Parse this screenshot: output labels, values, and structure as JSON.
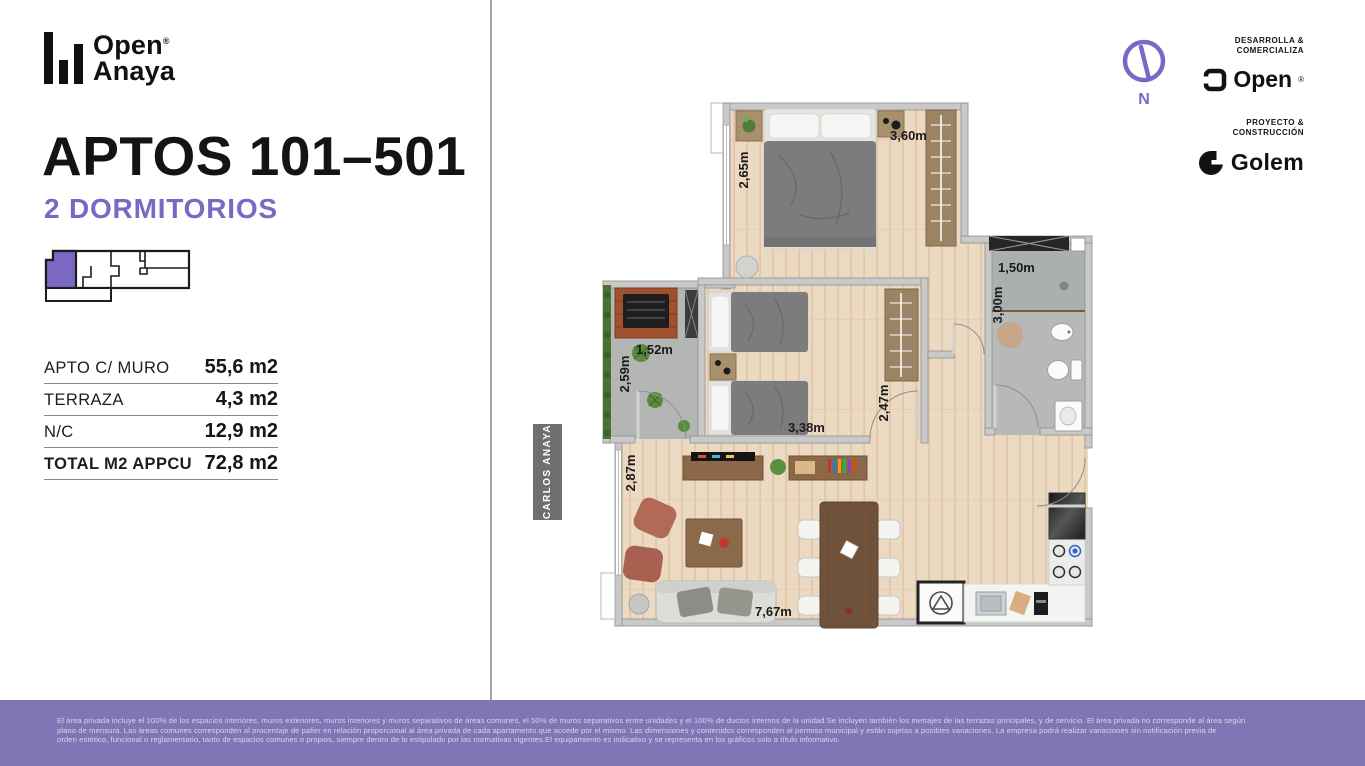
{
  "brand": {
    "name_line1": "Open",
    "name_line2": "Anaya",
    "registered": "®"
  },
  "left_panel": {
    "title": "APTOS 101–501",
    "subtitle": "2 DORMITORIOS",
    "area_table": {
      "rows": [
        {
          "label": "APTO C/ MURO",
          "value": "55,6 m2"
        },
        {
          "label": "TERRAZA",
          "value": "4,3 m2"
        },
        {
          "label": "N/C",
          "value": "12,9 m2"
        },
        {
          "label": "TOTAL M2 APPCU",
          "value": "72,8 m2"
        }
      ]
    }
  },
  "plan": {
    "street_label": "CARLOS ANAYA",
    "compass_label": "N",
    "dimensions": {
      "master_width": "3,60m",
      "master_depth": "2,65m",
      "bath_width": "1,50m",
      "bath_depth": "3,00m",
      "terrace_width": "1,52m",
      "terrace_depth": "2,59m",
      "bedroom2_width": "3,38m",
      "hall_depth": "2,47m",
      "living_depth": "2,87m",
      "living_width": "7,67m"
    }
  },
  "credits": {
    "developer_heading_line1": "DESARROLLA &",
    "developer_heading_line2": "COMERCIALIZA",
    "developer_name": "Open",
    "developer_registered": "®",
    "builder_heading_line1": "PROYECTO &",
    "builder_heading_line2": "CONSTRUCCIÓN",
    "builder_name": "Golem"
  },
  "colors": {
    "accent": "#7B68C5",
    "footer_bg": "#8175B5",
    "wall": "#C9C9C9",
    "wood": "#ECD9C2",
    "tile": "#B7B9B8"
  },
  "footer": {
    "line1": "El área privada incluye el 100% de los espacios interiores, muros exteriores, muros interiores y muros separativos de áreas comunes, el 50% de muros separativos entre unidades y el 100% de ductos internos de la unidad.Se incluyen también los metrajes de las terrazas principales, y de servicio. El área privada no corresponde al área según",
    "line2": "plano de mensura. Las áreas comunes corresponden al procentaje de palier en relación proporcional al área privada de cada apartamento que accede por el mismo. Las dimensiones y contenidos corresponden al permiso municipal y están sujetas a posibles variaciones. La empresa podrá realizar variaciones sin notificación previa de",
    "line3": "orden estético, funcional o reglamentario, tanto de espacios comunes o propios, siempre dentro de lo estipulado por las normativas vigentes.El equipamiento es indicativo y se representa en los gráficos solo a título informativo."
  }
}
